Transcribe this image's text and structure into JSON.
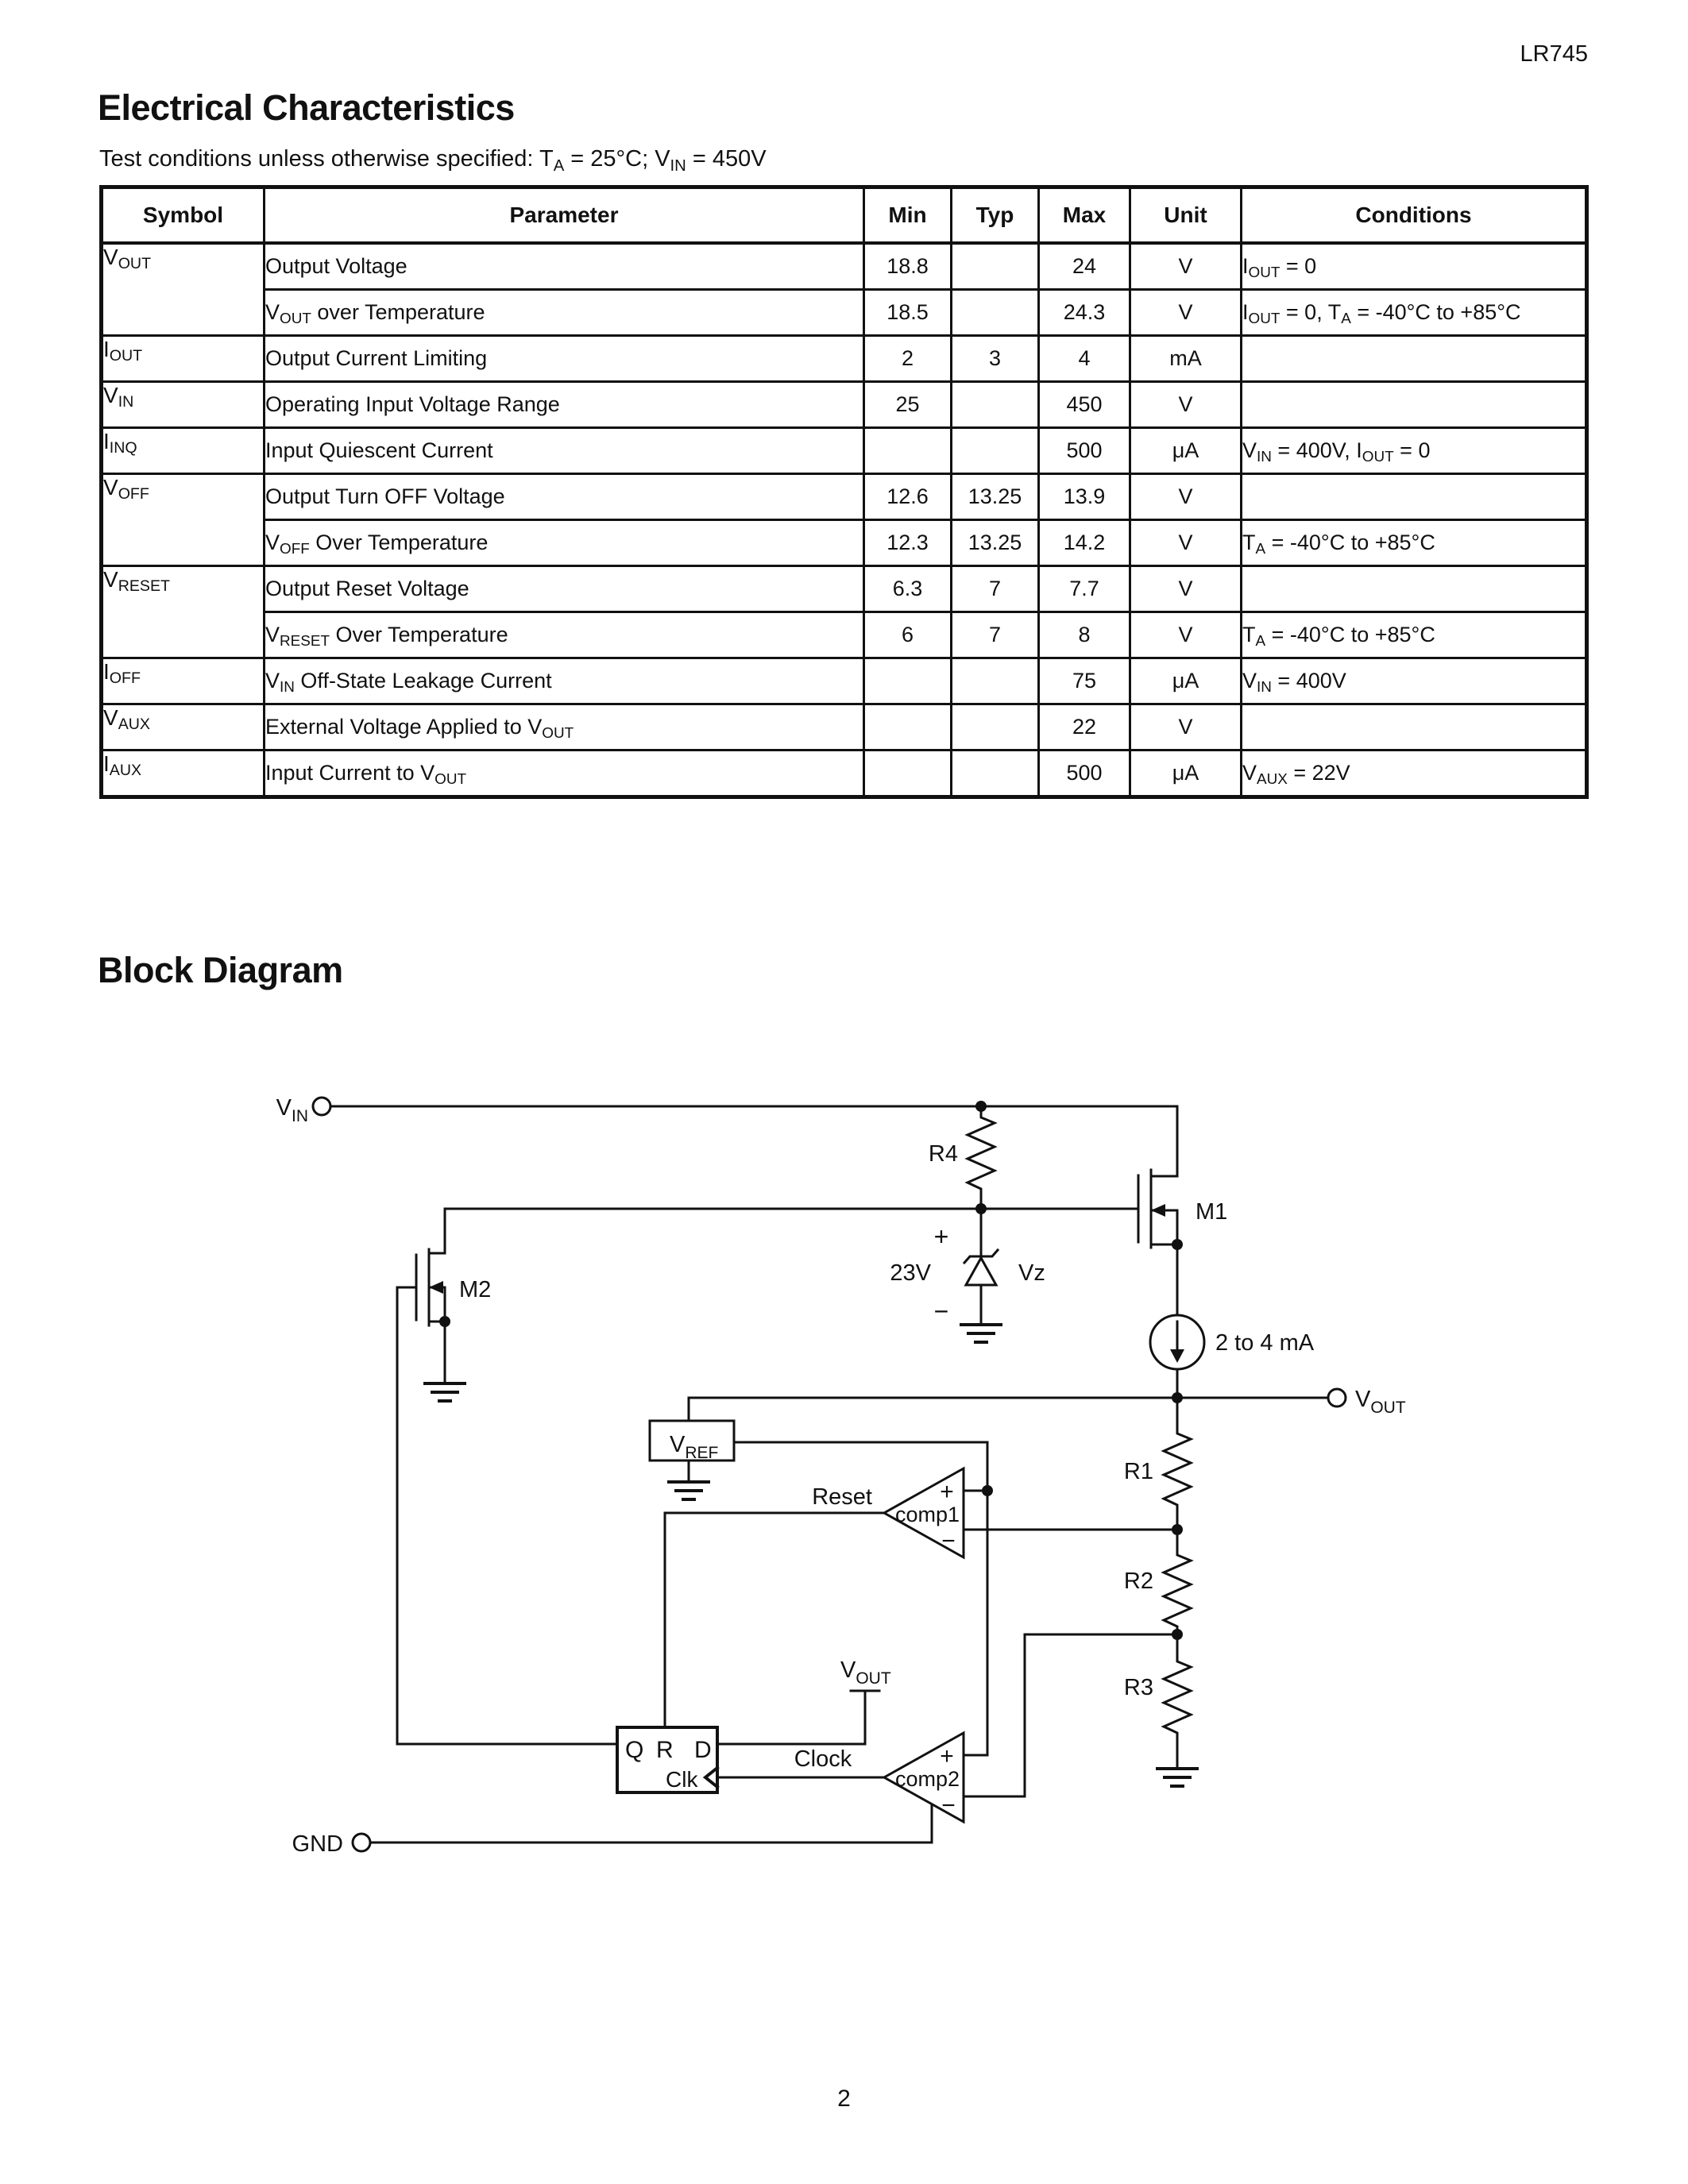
{
  "page": {
    "doc_code": "LR745",
    "page_number": "2"
  },
  "electrical_characteristics": {
    "title": "Electrical Characteristics",
    "test_conditions": "Test conditions unless otherwise specified: T~A~ = 25°C; V~IN~ = 450V",
    "table": {
      "headers": [
        "Symbol",
        "Parameter",
        "Min",
        "Typ",
        "Max",
        "Unit",
        "Conditions"
      ],
      "rows": [
        {
          "symbol": "V~OUT~",
          "parameter": "Output Voltage",
          "min": "18.8",
          "typ": "",
          "max": "24",
          "unit": "V",
          "conditions": "I~OUT~ = 0"
        },
        {
          "symbol": "",
          "parameter": "V~OUT~ over Temperature",
          "min": "18.5",
          "typ": "",
          "max": "24.3",
          "unit": "V",
          "conditions": "I~OUT~ = 0, T~A~ = -40°C to +85°C"
        },
        {
          "symbol": "I~OUT~",
          "parameter": "Output Current Limiting",
          "min": "2",
          "typ": "3",
          "max": "4",
          "unit": "mA",
          "conditions": ""
        },
        {
          "symbol": "V~IN~",
          "parameter": "Operating Input Voltage Range",
          "min": "25",
          "typ": "",
          "max": "450",
          "unit": "V",
          "conditions": ""
        },
        {
          "symbol": "I~INQ~",
          "parameter": "Input Quiescent Current",
          "min": "",
          "typ": "",
          "max": "500",
          "unit": "μA",
          "conditions": "V~IN~ = 400V, I~OUT~ = 0"
        },
        {
          "symbol": "V~OFF~",
          "parameter": "Output Turn OFF Voltage",
          "min": "12.6",
          "typ": "13.25",
          "max": "13.9",
          "unit": "V",
          "conditions": ""
        },
        {
          "symbol": "",
          "parameter": "V~OFF~ Over Temperature",
          "min": "12.3",
          "typ": "13.25",
          "max": "14.2",
          "unit": "V",
          "conditions": "T~A~ = -40°C to +85°C"
        },
        {
          "symbol": "V~RESET~",
          "parameter": "Output Reset Voltage",
          "min": "6.3",
          "typ": "7",
          "max": "7.7",
          "unit": "V",
          "conditions": ""
        },
        {
          "symbol": "",
          "parameter": "V~RESET~ Over Temperature",
          "min": "6",
          "typ": "7",
          "max": "8",
          "unit": "V",
          "conditions": "T~A~ = -40°C to +85°C"
        },
        {
          "symbol": "I~OFF~",
          "parameter": "V~IN~ Off-State Leakage Current",
          "min": "",
          "typ": "",
          "max": "75",
          "unit": "μA",
          "conditions": "V~IN~ = 400V"
        },
        {
          "symbol": "V~AUX~",
          "parameter": "External Voltage Applied to V~OUT~",
          "min": "",
          "typ": "",
          "max": "22",
          "unit": "V",
          "conditions": ""
        },
        {
          "symbol": "I~AUX~",
          "parameter": "Input Current to V~OUT~",
          "min": "",
          "typ": "",
          "max": "500",
          "unit": "μA",
          "conditions": "V~AUX~ = 22V"
        }
      ]
    }
  },
  "block_diagram": {
    "title": "Block Diagram",
    "labels": {
      "vin_base": "V",
      "vin_sub": "IN",
      "vout_base": "V",
      "vout_sub": "OUT",
      "vref_base": "V",
      "vref_sub": "REF",
      "gnd": "GND",
      "r1": "R1",
      "r2": "R2",
      "r3": "R3",
      "r4": "R4",
      "m1": "M1",
      "m2": "M2",
      "zener_voltage": "23V",
      "zener_name": "Vz",
      "plus": "+",
      "minus": "−",
      "current_source": "2 to 4 mA",
      "comp1": "comp1",
      "comp2": "comp2",
      "reset": "Reset",
      "clock": "Clock",
      "ff_q": "Q",
      "ff_r": "R",
      "ff_d": "D",
      "ff_clk": "Clk"
    }
  }
}
